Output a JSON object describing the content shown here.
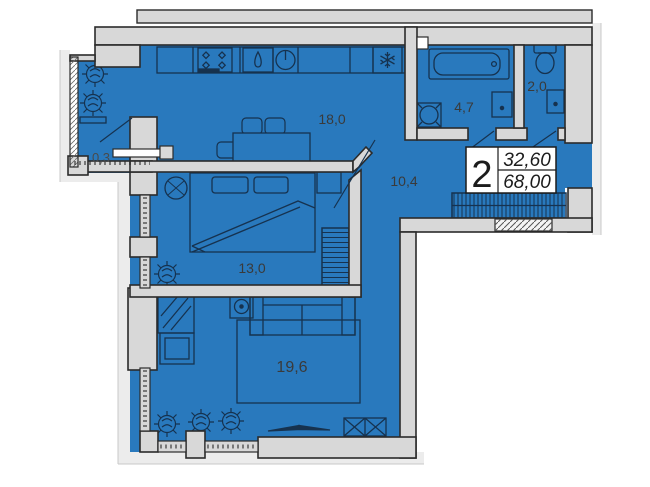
{
  "plan": {
    "title": "2-room apartment floor plan",
    "stamp": {
      "rooms_count": "2",
      "living_area": "32,60",
      "total_area": "68,00"
    },
    "rooms": {
      "balcony": {
        "name": "balcony",
        "area": "0,3"
      },
      "kitchen_living": {
        "name": "kitchen-living",
        "area": "18,0"
      },
      "hallway": {
        "name": "hallway",
        "area": "10,4"
      },
      "bathroom": {
        "name": "bathroom",
        "area": "4,7"
      },
      "wc": {
        "name": "wc",
        "area": "2,0"
      },
      "bedroom": {
        "name": "bedroom",
        "area": "13,0"
      },
      "living_room": {
        "name": "living room",
        "area": "19,6"
      }
    },
    "icons": [
      "stove-icon",
      "sink-icon",
      "washing-machine-icon",
      "fridge-snowflake-icon",
      "dining-table-icon",
      "chair-icon",
      "bed-icon",
      "pillow-icon",
      "nightstand-icon",
      "wardrobe-hatch-icon",
      "coat-rack-hatch-icon",
      "plant-icon",
      "sofa-icon",
      "speaker-icon",
      "mirror-wardrobe-icon",
      "rug-icon",
      "tv-icon",
      "crossed-cabinet-icon",
      "bathtub-icon",
      "toilet-icon",
      "washbasin-icon",
      "door-leaf-icon",
      "window-icon"
    ],
    "colors": {
      "floor_blue": "#2979BD",
      "wall_gray": "#D8D8D8",
      "wall_outline": "#2B2B2B",
      "furniture_line": "#16324F",
      "halo_gray": "#ECECEC",
      "paper": "#FFFFFF"
    }
  }
}
